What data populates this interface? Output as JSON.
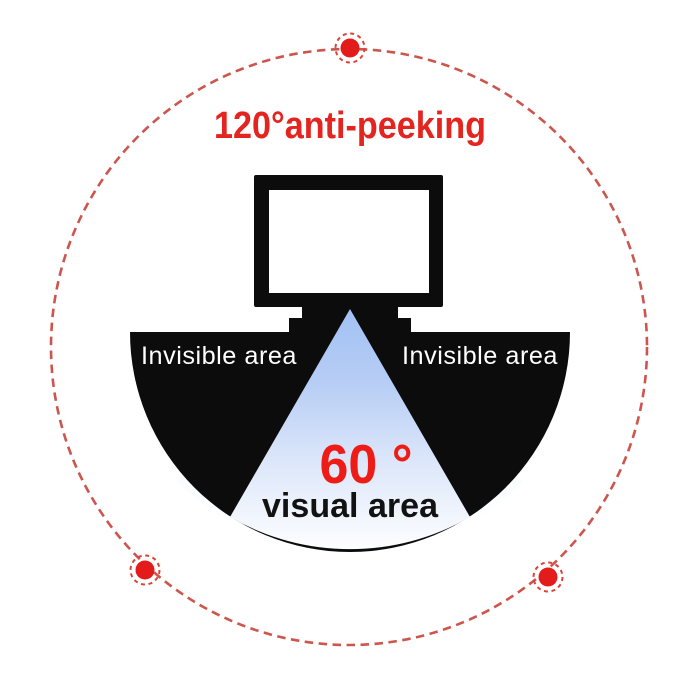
{
  "diagram": {
    "title": "120°anti-peeking",
    "cone": {
      "angle_label": "60 °",
      "area_label": "visual area"
    },
    "invisible_areas": {
      "left_label": "Invisible area",
      "right_label": "Invisible area"
    }
  },
  "colors": {
    "title_red": "#e3241f",
    "angle_red": "#ee1c17",
    "dashed_circle_red": "#cc564d",
    "dot_fill_red": "#e41b1b",
    "dot_ring_red": "#d8433b",
    "shape_black": "#0c0c0c",
    "cone_blue_top": "#a2c1f3",
    "cone_blue_fade": "#ffffff",
    "background": "#ffffff"
  }
}
